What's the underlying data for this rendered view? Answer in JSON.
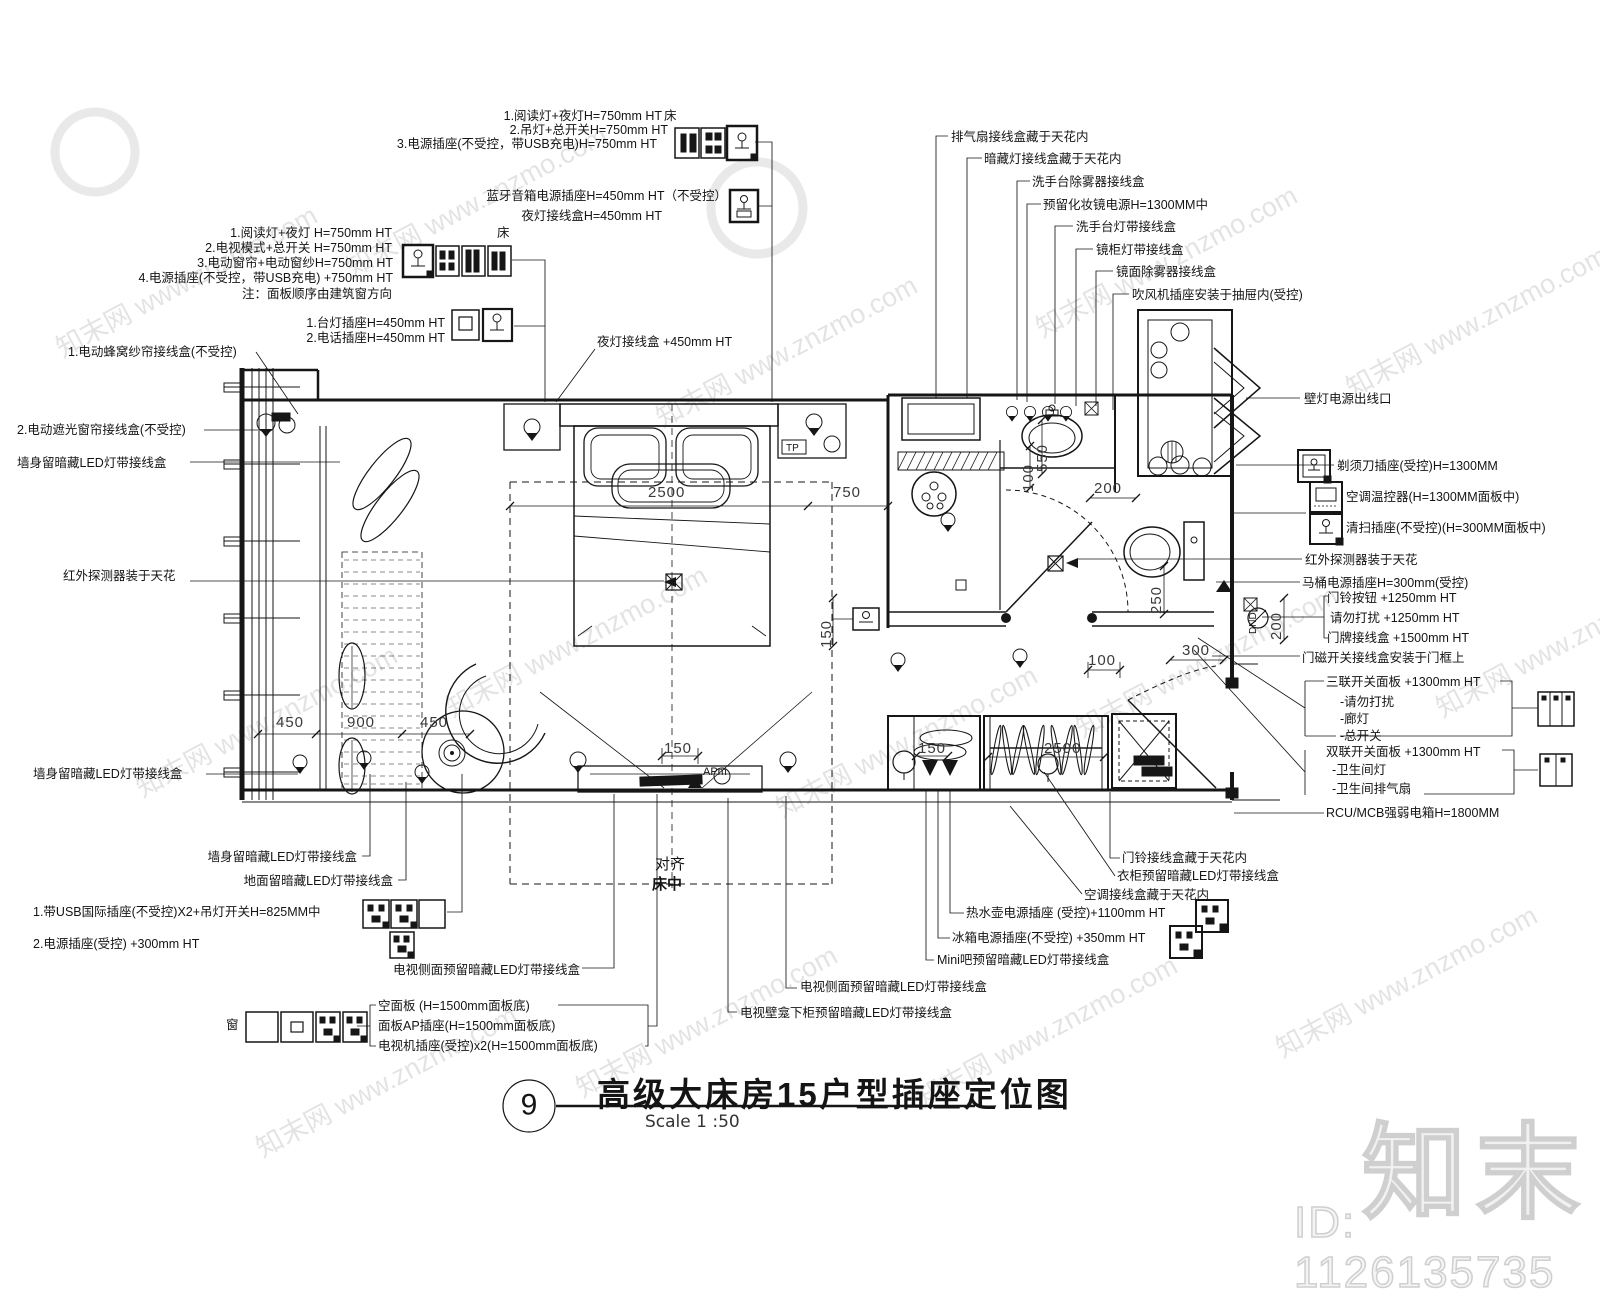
{
  "watermark": {
    "site_text": "知末网 www.znzmo.com",
    "brand": "知末",
    "id": "ID: 1126135735"
  },
  "title_block": {
    "number": "9",
    "title": "高级大床房15户型插座定位图",
    "scale": "Scale 1 :50"
  },
  "labels": {
    "g1_l1": "1.阅读灯+夜灯H=750mm HT",
    "g1_l2": "2.吊灯+总开关H=750mm HT",
    "g1_l3": "3.电源插座(不受控，带USB充电)H=750mm HT",
    "g1_bed": "床",
    "g2_l1": "蓝牙音箱电源插座H=450mm HT（不受控）",
    "g2_l2": "夜灯接线盒H=450mm HT",
    "g3_l1": "1.阅读灯+夜灯 H=750mm HT",
    "g3_l2": "2.电视模式+总开关 H=750mm HT",
    "g3_l3": "3.电动窗帘+电动窗纱H=750mm HT",
    "g3_l4": "4.电源插座(不受控，带USB充电) +750mm HT",
    "g3_l5": "注：面板顺序由建筑窗方向",
    "g3_bed": "床",
    "g4_l1": "1.台灯插座H=450mm HT",
    "g4_l2": "2.电话插座H=450mm HT",
    "honeycomb": "1.电动蜂窝纱帘接线盒(不受控)",
    "blackout": "2.电动遮光窗帘接线盒(不受控)",
    "wall_led_1": "墙身留暗藏LED灯带接线盒",
    "ir_left": "红外探测器装于天花",
    "night_box": "夜灯接线盒 +450mm HT",
    "wall_led_2": "墙身留暗藏LED灯带接线盒",
    "wall_led_3": "墙身留暗藏LED灯带接线盒",
    "floor_led": "地面留暗藏LED灯带接线盒",
    "usb_intl": "1.带USB国际插座(不受控)X2+吊灯开关H=825MM中",
    "power_300": "2.电源插座(受控) +300mm HT",
    "tv_side_led_l": "电视侧面预留暗藏LED灯带接线盒",
    "blank_panel": "空面板 (H=1500mm面板底)",
    "ap_panel": "面板AP插座(H=1500mm面板底)",
    "tv_socket": "电视机插座(受控)x2(H=1500mm面板底)",
    "window_lbl": "窗",
    "align1": "对齐",
    "align2": "床中",
    "exhaust": "排气扇接线盒藏于天花内",
    "concealed": "暗藏灯接线盒藏于天花内",
    "basin_defog": "洗手台除雾器接线盒",
    "makeup": "预留化妆镜电源H=1300MM中",
    "basin_led": "洗手台灯带接线盒",
    "mirror_cab": "镜柜灯带接线盒",
    "mirror_defog": "镜面除雾器接线盒",
    "hairdryer": "吹风机插座安装于抽屉内(受控)",
    "wall_lamp": "壁灯电源出线口",
    "shaver": "剃须刀插座(受控)H=1300MM",
    "thermostat": "空调温控器(H=1300MM面板中)",
    "cleaning": "清扫插座(不受控)(H=300MM面板中)",
    "ir_right": "红外探测器装于天花",
    "toilet_socket": "马桶电源插座H=300mm(受控)",
    "doorbell_btn": "门铃按钮 +1250mm HT",
    "dnd_lbl": "请勿打扰 +1250mm HT",
    "doorplate": "门牌接线盒 +1500mm HT",
    "door_magnet": "门磁开关接线盒安装于门框上",
    "triple_switch": "三联开关面板 +1300mm HT",
    "ts1": "-请勿打扰",
    "ts2": "-廊灯",
    "ts3": "-总开关",
    "double_switch": "双联开关面板 +1300mm HT",
    "ds1": "-卫生间灯",
    "ds2": "-卫生间排气扇",
    "rcu": "RCU/MCB强弱电箱H=1800MM",
    "doorbell_box": "门铃接线盒藏于天花内",
    "wardrobe_led": "衣柜预留暗藏LED灯带接线盒",
    "ac_box": "空调接线盒藏于天花内",
    "kettle": "热水壶电源插座 (受控)+1100mm HT",
    "fridge": "冰箱电源插座(不受控) +350mm HT",
    "minibar_led": "Mini吧预留暗藏LED灯带接线盒",
    "tv_side_led_r": "电视侧面预留暗藏LED灯带接线盒",
    "tv_niche_led": "电视壁龛下柜预留暗藏LED灯带接线盒"
  },
  "dims": {
    "bed_width": "2500",
    "bed_side": "750",
    "basin": "200",
    "basin_h": "550",
    "basin_s": "100",
    "bed_gap": "150",
    "win_a": "450",
    "win_b": "900",
    "win_c": "450",
    "tv": "150",
    "minibar": "150",
    "wardrobe": "2500",
    "toilet": "250",
    "entry": "200",
    "door_a": "100",
    "door_b": "300"
  },
  "plan_texts": {
    "tp": "TP",
    "apm": "APm",
    "dnd": "DND"
  }
}
